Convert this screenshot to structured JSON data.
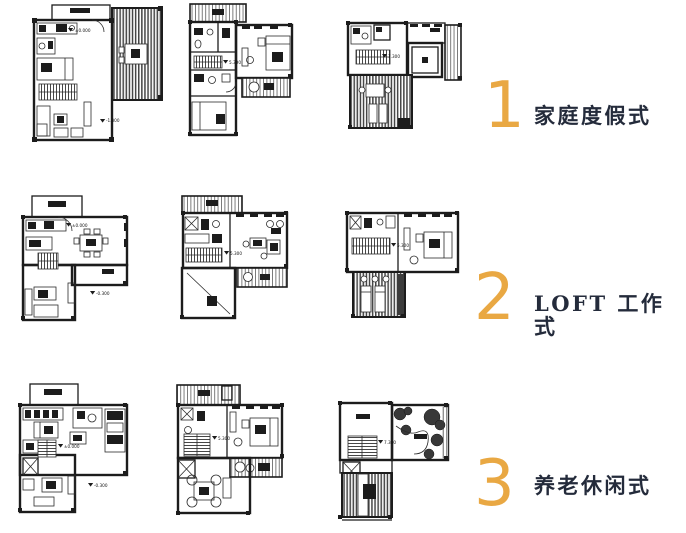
{
  "page": {
    "background": "#ffffff",
    "width": 686,
    "height": 533
  },
  "colors": {
    "accent": "#E9A843",
    "heading_text": "#242B3B",
    "linework": "#1c1c1c"
  },
  "schemes": [
    {
      "number": "1",
      "label": "家庭度假式"
    },
    {
      "number": "2",
      "label": "LOFT 工作式"
    },
    {
      "number": "3",
      "label": "养老休闲式"
    }
  ],
  "plans": {
    "p11": {
      "level": "±0.000",
      "level2": "-1.300"
    },
    "p12": {
      "level": "5.300"
    },
    "p13": {
      "level": "7.300"
    },
    "p21": {
      "level": "±0.000",
      "level2": "-0.300"
    },
    "p22": {
      "level": "5.300"
    },
    "p23": {
      "level": "5.300"
    },
    "p31": {
      "level": "±0.000",
      "level2": "-0.300"
    },
    "p32": {
      "level": "5.300"
    },
    "p33": {
      "level": "7.300"
    }
  }
}
